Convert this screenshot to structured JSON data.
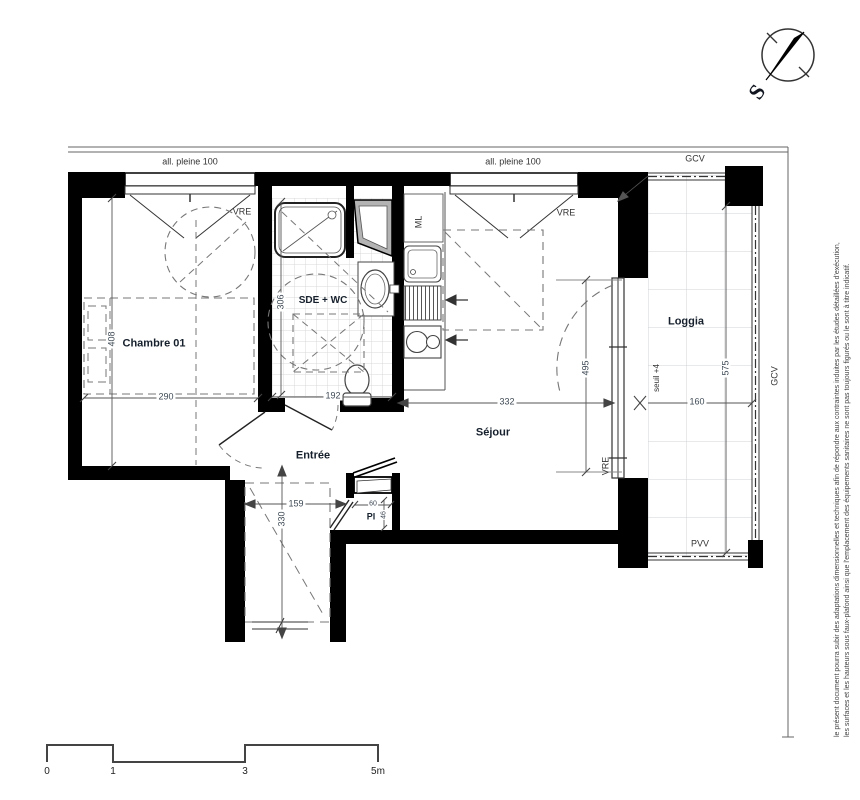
{
  "compass": {
    "letter": "S"
  },
  "rooms": {
    "bedroom": "Chambre 01",
    "bathroom": "SDE + WC",
    "entry": "Entrée",
    "living": "Séjour",
    "loggia": "Loggia",
    "closet": "Pl"
  },
  "annotations": {
    "allege_left": "all. pleine 100",
    "allege_right": "all. pleine 100",
    "gcv_top": "GCV",
    "gcv_right": "GCV",
    "vre_window_left": "VRE",
    "vre_window_right": "VRE",
    "vre_bay": "VRE",
    "pvv_bottom": "PVV",
    "washing_machine": "ML",
    "threshold": "seuil +4"
  },
  "dimensions_cm": {
    "bedroom_width": "290",
    "bedroom_depth": "408",
    "bathroom_width": "192",
    "bathroom_depth": "306",
    "living_width": "332",
    "living_depth": "495",
    "loggia_width": "160",
    "loggia_depth": "575",
    "entry_width": "159",
    "entry_depth": "330",
    "closet_width": "60",
    "closet_depth": "46"
  },
  "scale_bar": {
    "ticks": [
      "0",
      "1",
      "3",
      "5m"
    ]
  },
  "disclaimer": {
    "line1": "le présent document pourra subir des adaptations dimensionnelles et techniques afin de répondre aux contraintes induites par les études détaillées d'exécution,",
    "line2": "les surfaces et les hauteurs sous faux-plafond ainsi que l'emplacement des équipements sanitaires ne sont pas toujours figurés ou le sont à titre indicatif."
  },
  "colors": {
    "wall": "#000000",
    "line": "#333333",
    "dashed": "#777777",
    "tile_grid": "#d9d9d9",
    "loggia_grid": "#cfd3d6",
    "duct_fill": "#b3b3b3",
    "room_label": "#16202c",
    "dim_label": "#3f4a55"
  }
}
